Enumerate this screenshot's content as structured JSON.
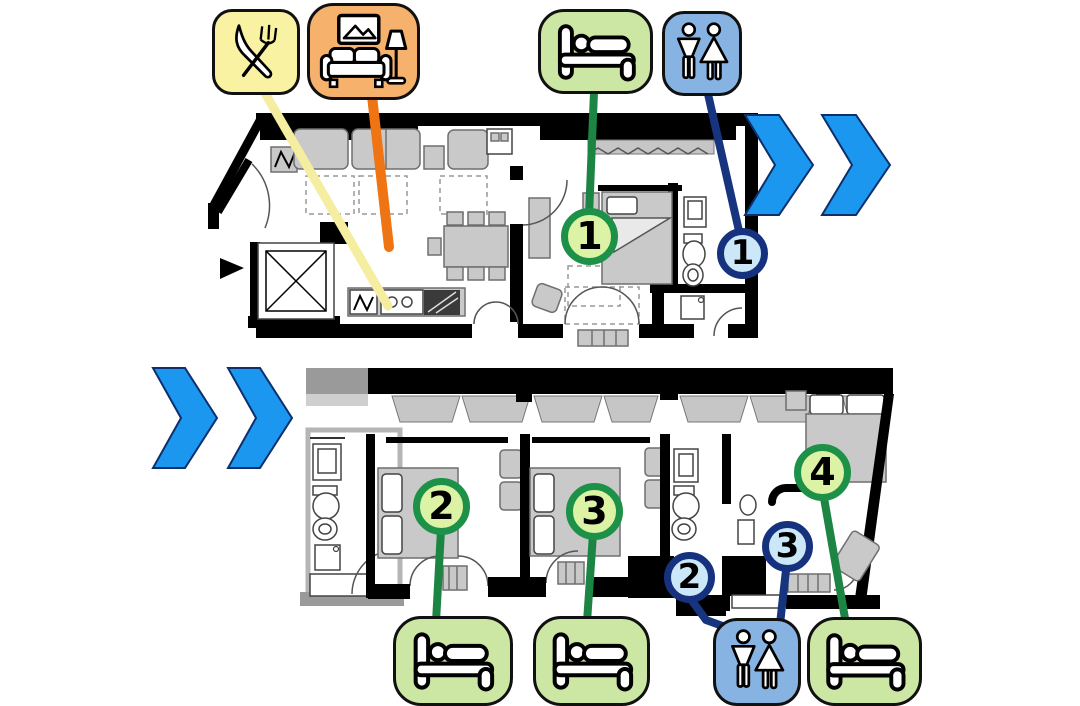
{
  "canvas": {
    "width": 1080,
    "height": 706,
    "background": "#ffffff"
  },
  "colors": {
    "canvas-bg": "#ffffff",
    "dining-badge-bg": "#f8f2a2",
    "living-badge-bg": "#f6b16d",
    "bedroom-badge-bg": "#cce6a4",
    "wc-badge-bg": "#87b3e3",
    "badge-border": "#111111",
    "chevron-fill": "#1b97f0",
    "chevron-border": "#0d2f6b",
    "dining-line": "#f5eda0",
    "living-line": "#ee7414",
    "bedroom-line": "#1d8544",
    "wc-line": "#17357f",
    "bedroom-marker-bg": "#dcf3a5",
    "bedroom-marker-border": "#1e9148",
    "wc-marker-bg": "#cce7f7",
    "wc-marker-border": "#16327e",
    "marker-number": "#000000",
    "plan-wall": "#000000",
    "plan-furniture": "#c9c9c9",
    "plan-furniture-border": "#6f6f6f"
  },
  "legend": {
    "top": [
      {
        "id": "dining",
        "icon": "fork-knife-icon"
      },
      {
        "id": "living-room",
        "icon": "sofa-lamp-icon"
      },
      {
        "id": "bedroom-1",
        "icon": "bed-icon"
      },
      {
        "id": "toilet-1",
        "icon": "wc-icon"
      }
    ],
    "bottom": [
      {
        "id": "bedroom-2",
        "icon": "bed-icon"
      },
      {
        "id": "bedroom-3",
        "icon": "bed-icon"
      },
      {
        "id": "toilet-lower",
        "icon": "wc-icon"
      },
      {
        "id": "bedroom-4",
        "icon": "bed-icon"
      }
    ]
  },
  "markers": {
    "bedrooms": [
      {
        "label": "1"
      },
      {
        "label": "2"
      },
      {
        "label": "3"
      },
      {
        "label": "4"
      }
    ],
    "toilets": [
      {
        "label": "1"
      },
      {
        "label": "2"
      },
      {
        "label": "3"
      }
    ]
  }
}
